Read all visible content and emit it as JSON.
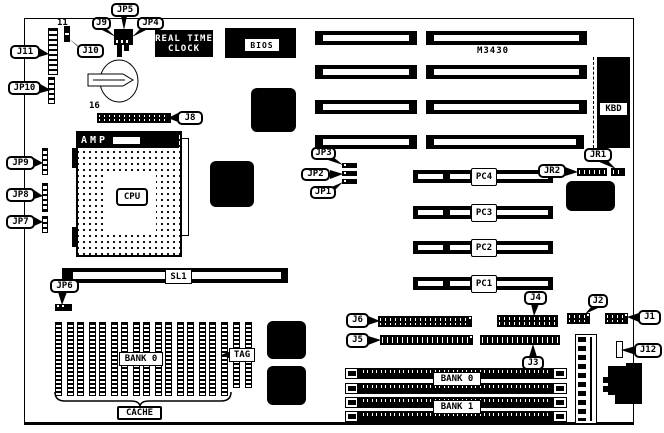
{
  "board": {
    "model": "M3430"
  },
  "chips": {
    "rtc_line1": "REAL TIME",
    "rtc_line2": "CLOCK",
    "bios": "BIOS",
    "kbd": "KBD",
    "amp": "AMP"
  },
  "cpu": {
    "label": "CPU"
  },
  "slots": {
    "sl1": "SL1",
    "pc1": "PC1",
    "pc2": "PC2",
    "pc3": "PC3",
    "pc4": "PC4",
    "bank0": "BANK 0",
    "bank1": "BANK 1"
  },
  "cache": {
    "bank_label": "BANK 0",
    "tag_label": "TAG",
    "brace_label": "CACHE"
  },
  "connectors": {
    "j1": "J1",
    "j2": "J2",
    "j3": "J3",
    "j4": "J4",
    "j5": "J5",
    "j6": "J6",
    "j8": "J8",
    "j9": "J9",
    "j10": "J10",
    "j11": "J11",
    "j12": "J12",
    "jp1": "JP1",
    "jp2": "JP2",
    "jp3": "JP3",
    "jp4": "JP4",
    "jp5": "JP5",
    "jp6": "JP6",
    "jp7": "JP7",
    "jp8": "JP8",
    "jp9": "JP9",
    "jp10": "JP10",
    "jr1": "JR1",
    "jr2": "JR2"
  },
  "pins": {
    "j11_count": "11",
    "j8_count": "16"
  },
  "colors": {
    "ink": "#000000",
    "paper": "#ffffff"
  }
}
